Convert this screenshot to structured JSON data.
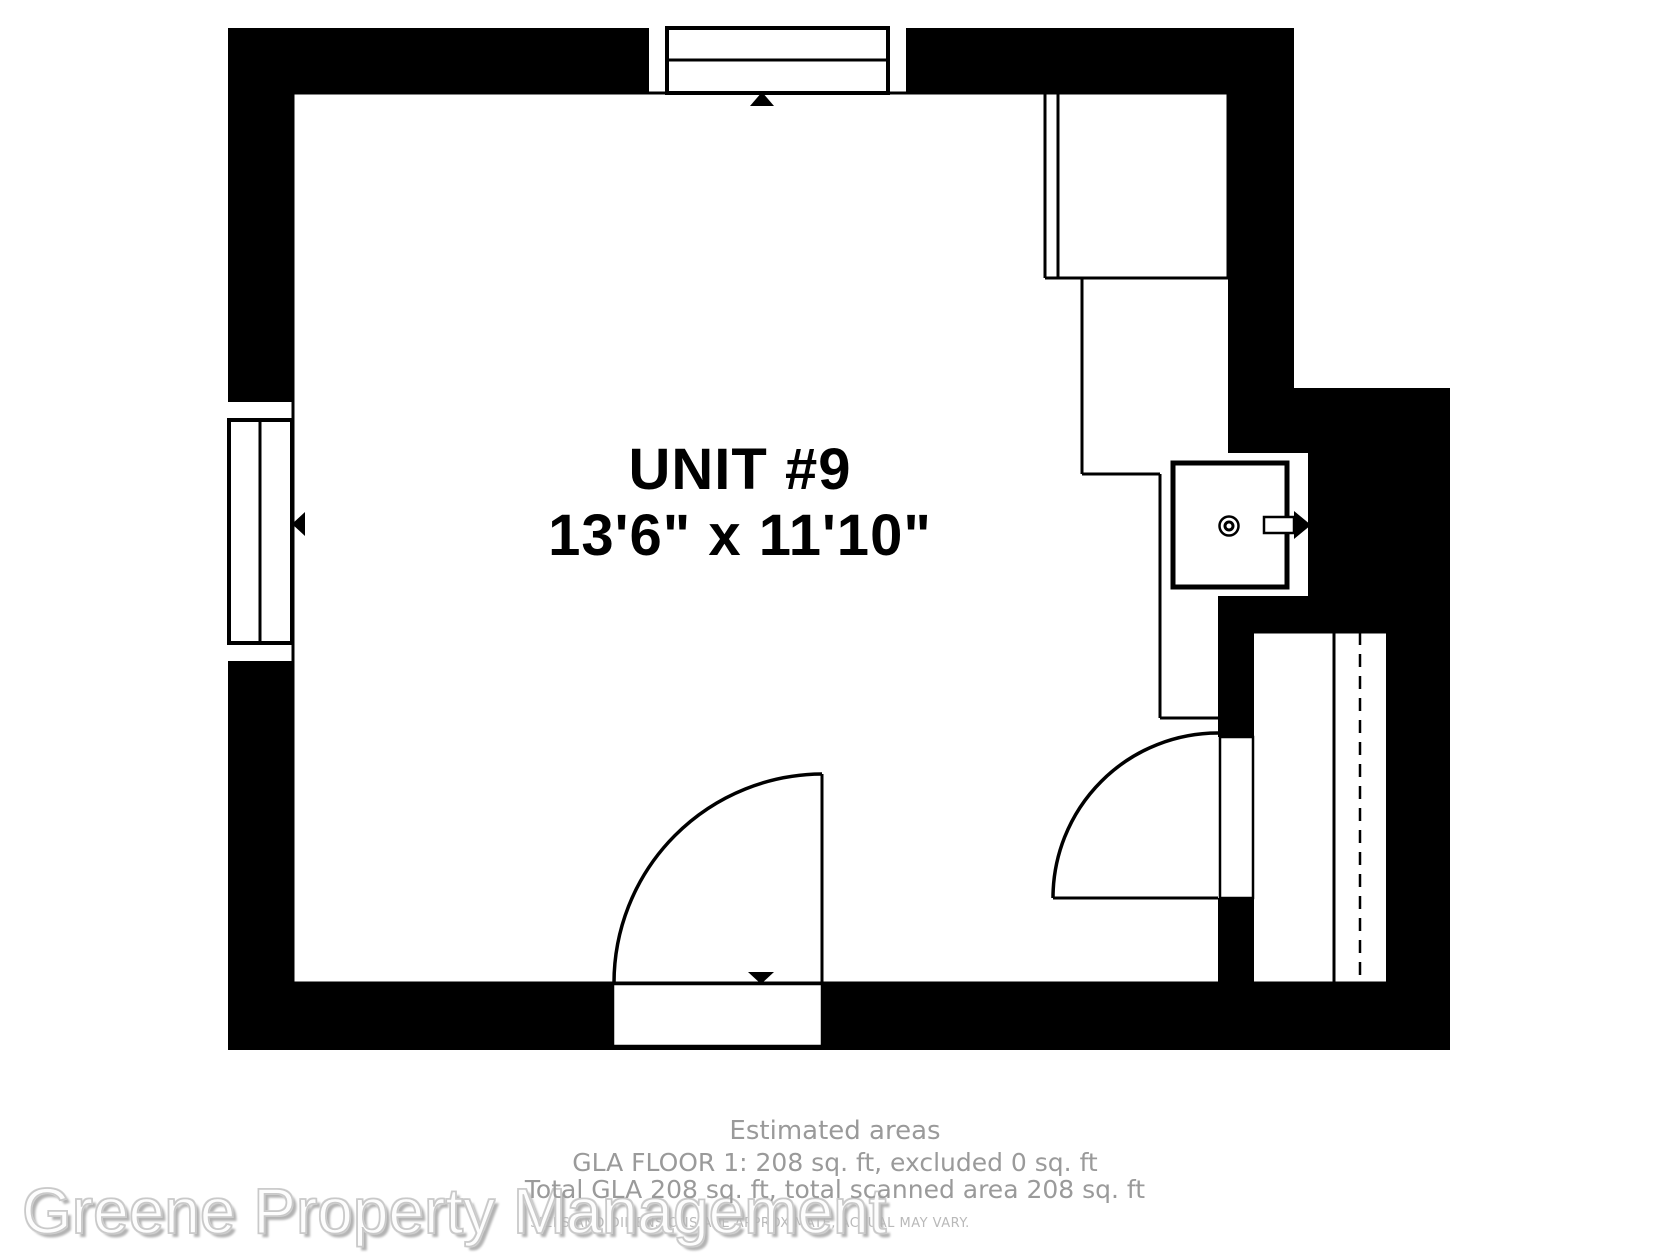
{
  "floorplan": {
    "room_label": "UNIT #9",
    "room_dimensions": "13'6\" x 11'10\""
  },
  "footer": {
    "estimated_areas_title": "Estimated areas",
    "gla_line1": "GLA FLOOR 1: 208 sq. ft, excluded 0 sq. ft",
    "gla_line2": "Total GLA 208 sq. ft, total scanned area 208 sq. ft",
    "disclaimer": "SIZES AND DIMENSIONS ARE APPROXIMATE, ACTUAL MAY VARY."
  },
  "watermark": {
    "text": "Greene Property Management"
  },
  "colors": {
    "wall": "#000000",
    "line": "#000000",
    "muted_text": "#9a9a9a",
    "disclaimer_text": "#b9b9b9",
    "watermark_outline": "#c9c9c9"
  }
}
